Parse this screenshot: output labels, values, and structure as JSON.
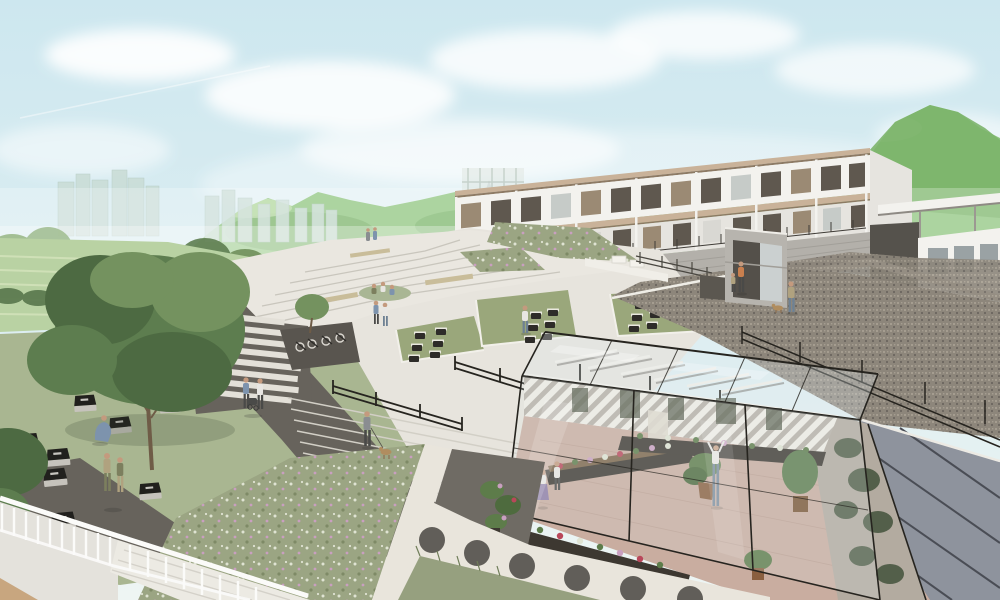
{
  "scene": {
    "type": "architectural-rendering",
    "subject": "terraced hillside campus with modular housing, plaza and greenhouse",
    "elements": [
      "sky",
      "clouds",
      "contrail",
      "city-skyline",
      "distant-downtown",
      "mountains",
      "farm-field",
      "hedge-row",
      "large-tree",
      "tree-row",
      "lawn",
      "modular-housing-block",
      "retaining-wall",
      "scaffold-structure",
      "elevator-tower",
      "right-pavilion",
      "covered-walkway",
      "terraced-steps",
      "planted-slope",
      "green-roof",
      "skylights",
      "gravel-slope",
      "edge-railing",
      "blue-grey-wall",
      "greenhouse",
      "plant-benches",
      "potted-plants",
      "pergola-beams",
      "central-stairs",
      "stair-handrails",
      "dark-footpath",
      "striped-paving",
      "bike-parking",
      "info-panels",
      "flower-meadow",
      "circle-paver-path",
      "white-balustrade",
      "corner-stairs",
      "wood-deck",
      "people",
      "dogs",
      "stroller"
    ]
  },
  "palette": {
    "sky_top": "#cde7ef",
    "sky_mid": "#ddeef2",
    "sky_low": "#eef5f3",
    "cloud": "#ffffff",
    "mountain_main": "#8fc57f",
    "mountain_dark": "#72ab61",
    "mountain_light": "#bbdca6",
    "mountain_right": "#7cb46c",
    "city_near": "#c9dcd5",
    "city_far": "#c3ced2",
    "field": "#b9d2a3",
    "furrow": "#d2e2ba",
    "hedge": "#5d7b50",
    "tree_dark": "#4d6a42",
    "tree_mid": "#5d7d4f",
    "tree_light": "#74925f",
    "tree_pale": "#a3bf94",
    "trunk": "#6f5c47",
    "lawn": "#a9b691",
    "building_white": "#f3f2ee",
    "building_shade": "#e6e4df",
    "roof_tan": "#c9b299",
    "roof_brown": "#8d7a64",
    "window_dark": "#5f584f",
    "window_wood": "#9b8a74",
    "window_glass": "#c6cbc8",
    "door_light": "#d9d8d3",
    "wall_concrete": "#b3b0aa",
    "wall_dark_base": "#8c8880",
    "walkway_light": "#d9d5cc",
    "terrace_light": "#eae7e0",
    "terrace_line": "#c9c6bd",
    "plaza_light": "#e7e4dd",
    "green_roof": "#9aa77b",
    "skylight": "#2e2c29",
    "gravel_base": "#8d867b",
    "gravel_light": "#a59d90",
    "gravel_dark": "#6f6962",
    "path_dark": "#67635c",
    "stripe_white": "#e3e0d8",
    "wall_blue": "#8e939d",
    "wall_joint": "#4a4d55",
    "frame_black": "#26241f",
    "stripe_bg": "#f0ede6",
    "stripe_fg": "#b7b0a7",
    "floor_brick": "#c9ada0",
    "ivy": "#43523c",
    "meadow": "#9ba583",
    "meadow_dark": "#7e8a66",
    "flower_pink": "#c99fc0",
    "flower_white": "#dfe3d2",
    "paver_circle": "#56534e",
    "path_light": "#e9e5dc",
    "railing_white": "#fbfbf9",
    "stair_pale": "#eceae3",
    "wood_deck": "#c8a67f",
    "glass_tint": "#dfe9ea",
    "bench_wood": "#7c6549",
    "planter_dark": "#3d3831",
    "plant_green": "#5d7c4a",
    "flower_red": "#b9475a",
    "skin": "#c49a7e",
    "person_blue": "#7d93ad",
    "person_jeans": "#6e8193",
    "person_orange": "#c97f4e",
    "person_purple": "#8d7ba6",
    "person_white": "#e8e6e2",
    "person_khaki": "#b0a27f",
    "person_olive": "#7c7f5e",
    "person_gray": "#8a8d91",
    "person_dark": "#4a4a48",
    "dog_tan": "#b08d5f",
    "panel_black": "#21201d",
    "panel_base": "#c6c3bc"
  }
}
